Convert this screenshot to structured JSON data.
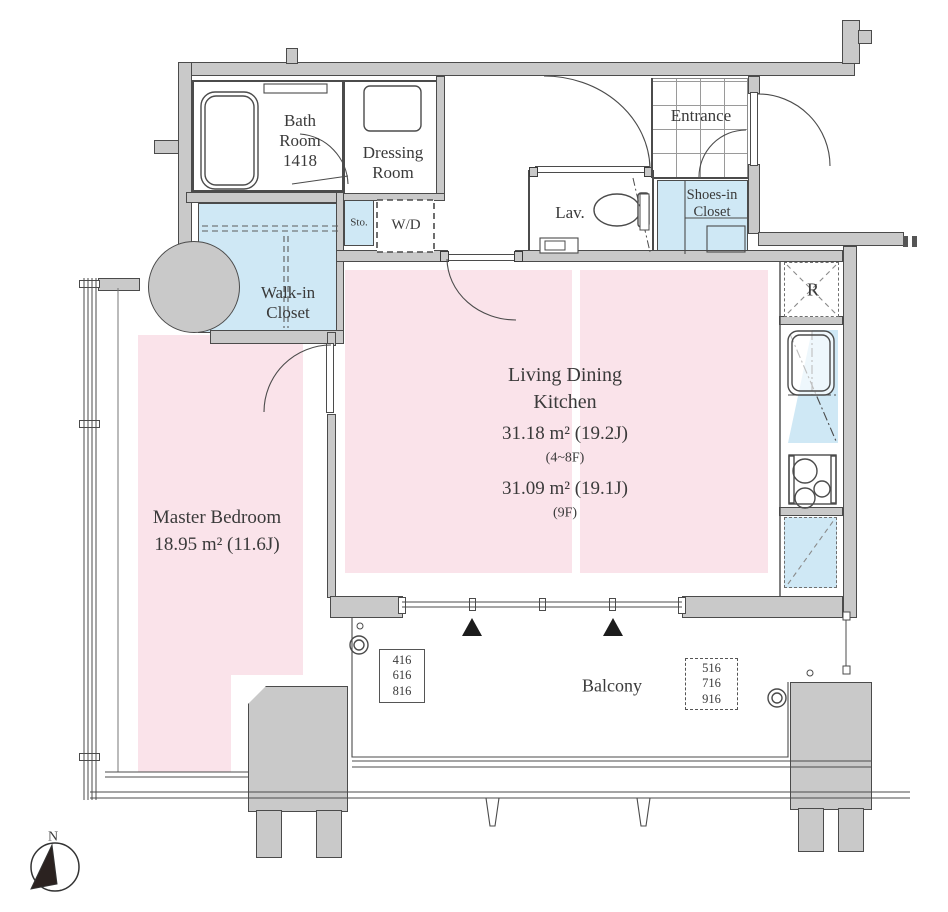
{
  "colors": {
    "wall_fill": "#c9c9c9",
    "outline": "#4b4b4b",
    "room_pink": "#fae3ea",
    "closet_blue": "#cfe8f5",
    "marker_black": "#1c1c1c"
  },
  "rooms": {
    "bath": {
      "line1": "Bath",
      "line2": "Room",
      "line3": "1418"
    },
    "dressing": {
      "line1": "Dressing",
      "line2": "Room"
    },
    "storage": {
      "label": "Sto."
    },
    "washer_dryer": {
      "label": "W/D"
    },
    "walk_in_closet": {
      "line1": "Walk-in",
      "line2": "Closet"
    },
    "lavatory": {
      "label": "Lav."
    },
    "entrance": {
      "label": "Entrance"
    },
    "shoes_closet": {
      "line1": "Shoes-in",
      "line2": "Closet"
    },
    "refrigerator": {
      "label": "R"
    },
    "living_dining_kitchen": {
      "line1": "Living Dining",
      "line2": "Kitchen",
      "area_main": "31.18 m² (19.2J)",
      "floors_main": "(4~8F)",
      "area_alt": "31.09 m² (19.1J)",
      "floors_alt": "(9F)"
    },
    "master_bedroom": {
      "name": "Master Bedroom",
      "area": "18.95 m² (11.6J)"
    },
    "balcony": {
      "label": "Balcony"
    }
  },
  "unit_numbers": {
    "left_box": [
      "416",
      "616",
      "816"
    ],
    "right_box": [
      "516",
      "716",
      "916"
    ]
  },
  "compass": {
    "label": "N"
  }
}
